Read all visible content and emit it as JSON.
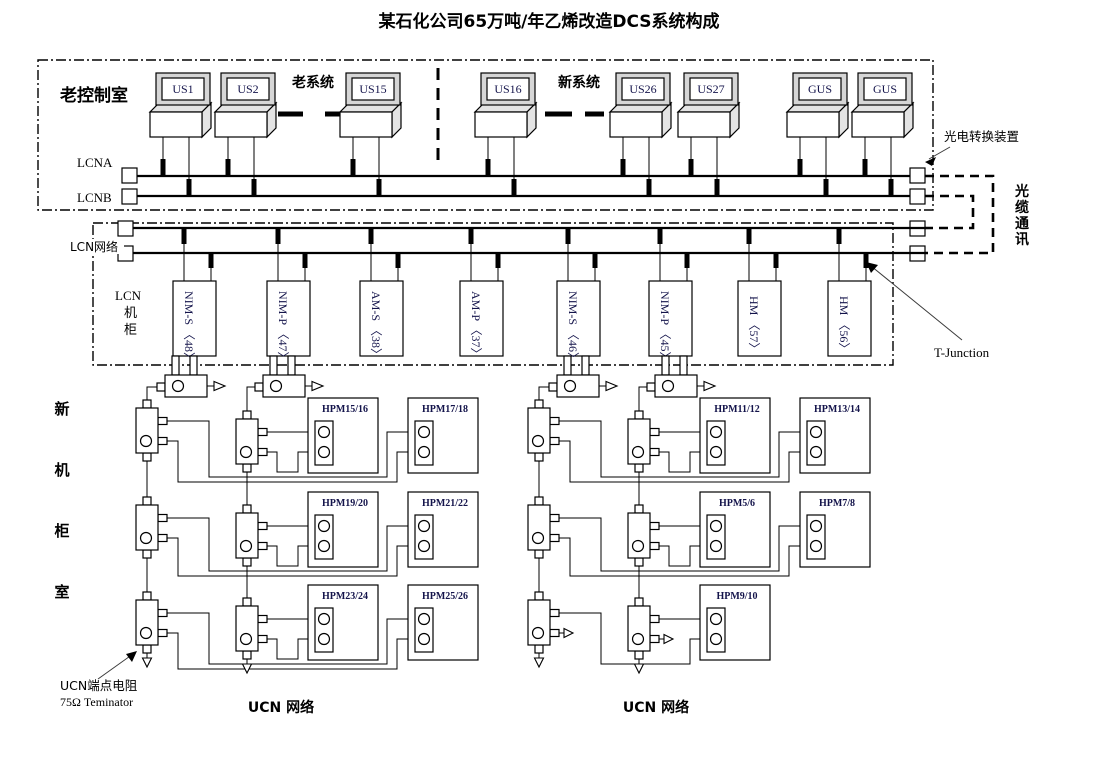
{
  "title": "某石化公司65万吨/年乙烯改造DCS系统构成",
  "old_control_room": {
    "label": "老控制室",
    "old_system": "老系统",
    "new_system": "新系统",
    "bus_a": "LCNA",
    "bus_b": "LCNB",
    "workstations": [
      "US1",
      "US2",
      "US15",
      "US16",
      "US26",
      "US27",
      "GUS",
      "GUS"
    ]
  },
  "fiber": {
    "converter_label": "光电转换装置",
    "channel_chars": [
      "光",
      "缆",
      "通",
      "讯"
    ]
  },
  "lcn": {
    "network_label": "LCN网络",
    "cabinet_chars": [
      "LCN",
      "机",
      "柜"
    ],
    "modules": [
      "NIM-S 〈48〉",
      "NIM-P 〈47〉",
      "AM-S 〈38〉",
      "AM-P 〈37〉",
      "NIM-S 〈46〉",
      "NIM-P 〈45〉",
      "HM 〈57〉",
      "HM 〈56〉"
    ],
    "t_junction": "T-Junction"
  },
  "ucn": {
    "room_chars": [
      "新",
      "机",
      "柜",
      "室"
    ],
    "hpm_left": [
      "HPM15/16",
      "HPM17/18",
      "HPM19/20",
      "HPM21/22",
      "HPM23/24",
      "HPM25/26"
    ],
    "hpm_right": [
      "HPM11/12",
      "HPM13/14",
      "HPM5/6",
      "HPM7/8",
      "HPM9/10"
    ],
    "terminator_line1": "UCN端点电阻",
    "terminator_line2": "75Ω Teminator",
    "network_left": "UCN 网络",
    "network_right": "UCN 网络"
  }
}
